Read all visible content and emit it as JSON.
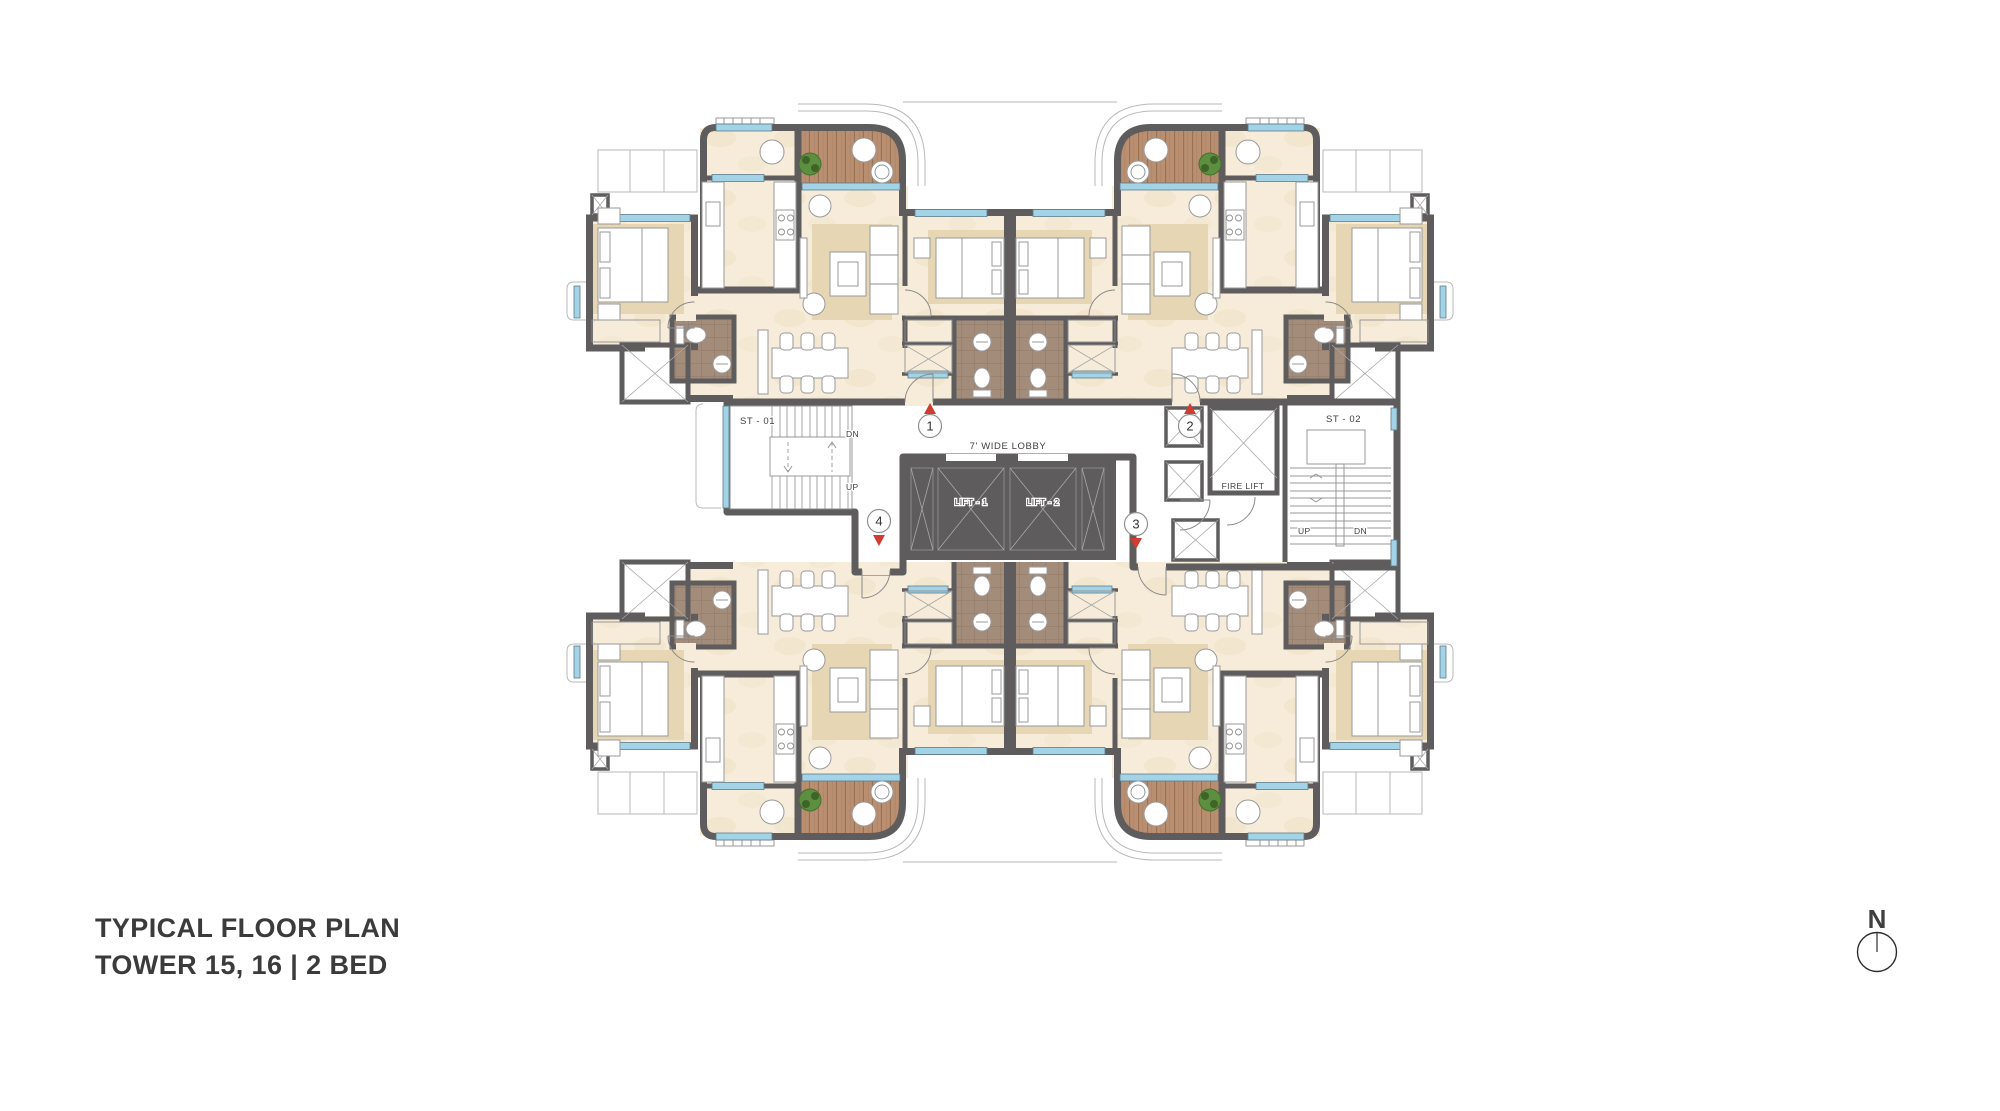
{
  "title": {
    "line1": "TYPICAL FLOOR PLAN",
    "line2": "TOWER 15, 16 | 2 BED"
  },
  "compass": {
    "label": "N"
  },
  "plan": {
    "lobby_label": "7' WIDE LOBBY",
    "stair1": {
      "label": "ST - 01",
      "up": "UP",
      "dn": "DN"
    },
    "stair2": {
      "label": "ST - 02",
      "up": "UP",
      "dn": "DN"
    },
    "lifts": {
      "lift1": "LIFT - 1",
      "lift2": "LIFT - 2",
      "fire": "FIRE LIFT"
    },
    "units": [
      {
        "number": "1"
      },
      {
        "number": "2"
      },
      {
        "number": "3"
      },
      {
        "number": "4"
      }
    ]
  },
  "colors": {
    "wall": "#5e5c5d",
    "floor": "#f6ecd9",
    "rug": "#e6d6b4",
    "deck": "#b98e71",
    "bath_tile": "#a48c7a",
    "window": "#a2d3e6",
    "lobby": "#e2e2e3",
    "marker_red": "#d23b2f",
    "plant": "#5c8f3f",
    "text": "#3b3b3b"
  }
}
